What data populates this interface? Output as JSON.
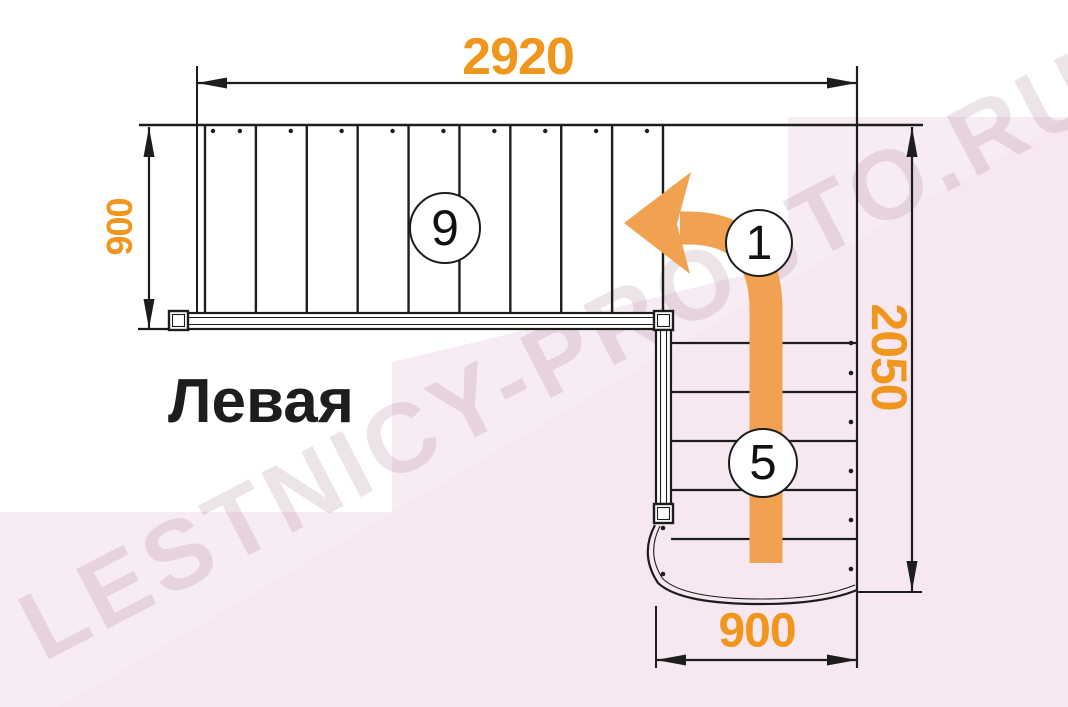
{
  "watermark": {
    "text": "LESTNICY-PROSTO.RU"
  },
  "plan": {
    "orientation_label": "Левая"
  },
  "dimensions": {
    "total_length_mm": "2920",
    "upper_flight_width_mm": "900",
    "total_depth_mm": "2050",
    "lower_flight_width_mm": "900"
  },
  "steps": {
    "upper_flight_count": "9",
    "turn_start_count": "1",
    "lower_flight_count": "5"
  },
  "colors": {
    "dimension_text": "#F0961D",
    "arrow_orange": "#F0A250",
    "line_black": "#1d1d1b",
    "background_tint": "#F8ECF4",
    "background_tint_dark": "#F3E2EE",
    "watermark_text": "rgba(125,75,110,0.15)"
  }
}
